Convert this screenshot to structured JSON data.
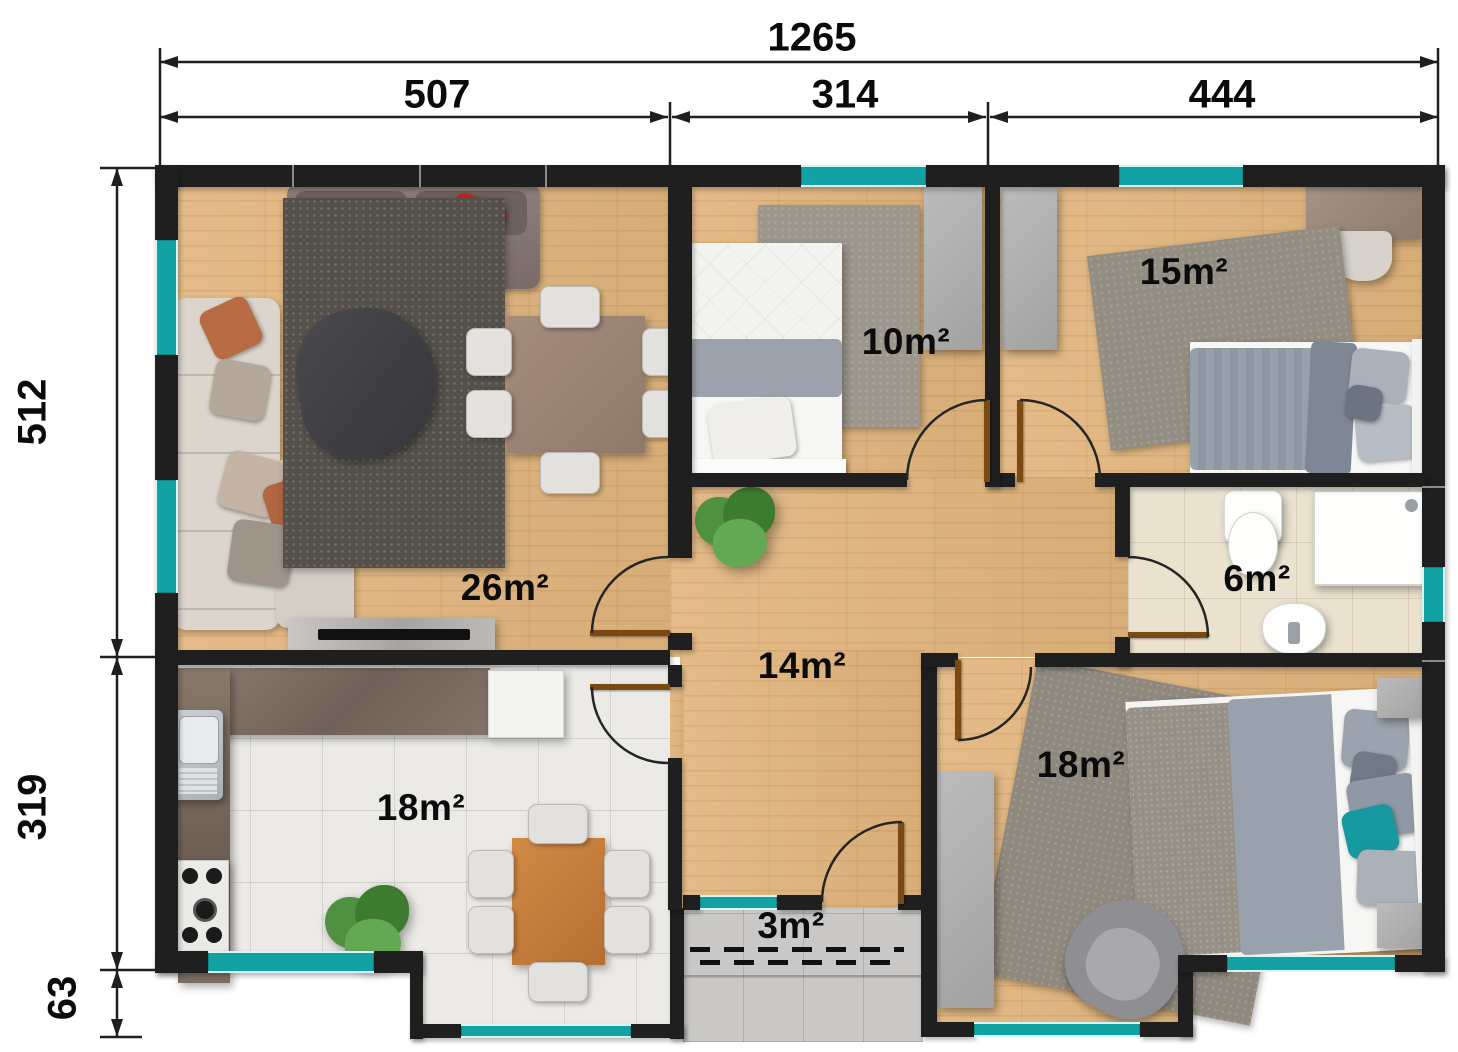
{
  "dimensions": {
    "total_width": "1265",
    "segments_top": [
      "507",
      "314",
      "444"
    ],
    "segments_left": [
      "512",
      "319",
      "63"
    ]
  },
  "rooms": {
    "living": "26m²",
    "bedroom_small": "10m²",
    "bedroom_mid": "15m²",
    "bathroom": "6m²",
    "hallway": "14m²",
    "kitchen": "18m²",
    "bedroom_large": "18m²",
    "entrance": "3m²"
  },
  "colors": {
    "wall": "#1f1f1f",
    "window": "#13a2a4",
    "wood_floor": "#e2b67e",
    "tile_floor": "#eceae6",
    "bath_tile": "#eae2cf",
    "entry_tile": "#c9c8c6",
    "counter": "#7c6e63",
    "door": "#7b4a12",
    "accent_red_pillow": "#c1261b",
    "accent_orange_pillow": "#e06a2e",
    "accent_teal_pillow": "#1598a0"
  }
}
